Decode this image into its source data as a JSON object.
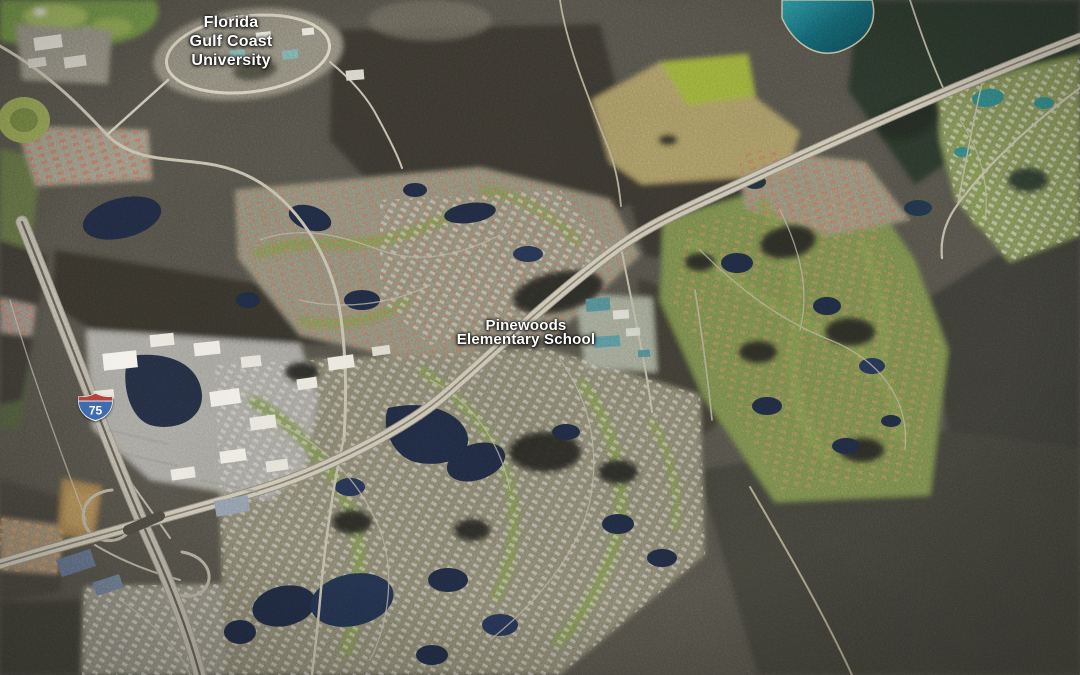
{
  "map": {
    "view_mode": "3D satellite aerial imagery",
    "labels": {
      "university": {
        "line1": "Florida",
        "line2": "Gulf Coast",
        "line3": "University"
      },
      "school": {
        "line1": "Pinewoods",
        "line2": "Elementary School"
      }
    },
    "shield": {
      "type": "interstate",
      "route_number": "75"
    },
    "palette": {
      "woodland": "#3a3832",
      "forest_dark": "#2a3529",
      "water_dark": "#1f2940",
      "water_teal": "#2f7f7f",
      "road_major": "#c9c3b1",
      "golf_green": "#7a8f4c",
      "field_tan": "#a29261",
      "label_text": "#ffffff"
    }
  }
}
